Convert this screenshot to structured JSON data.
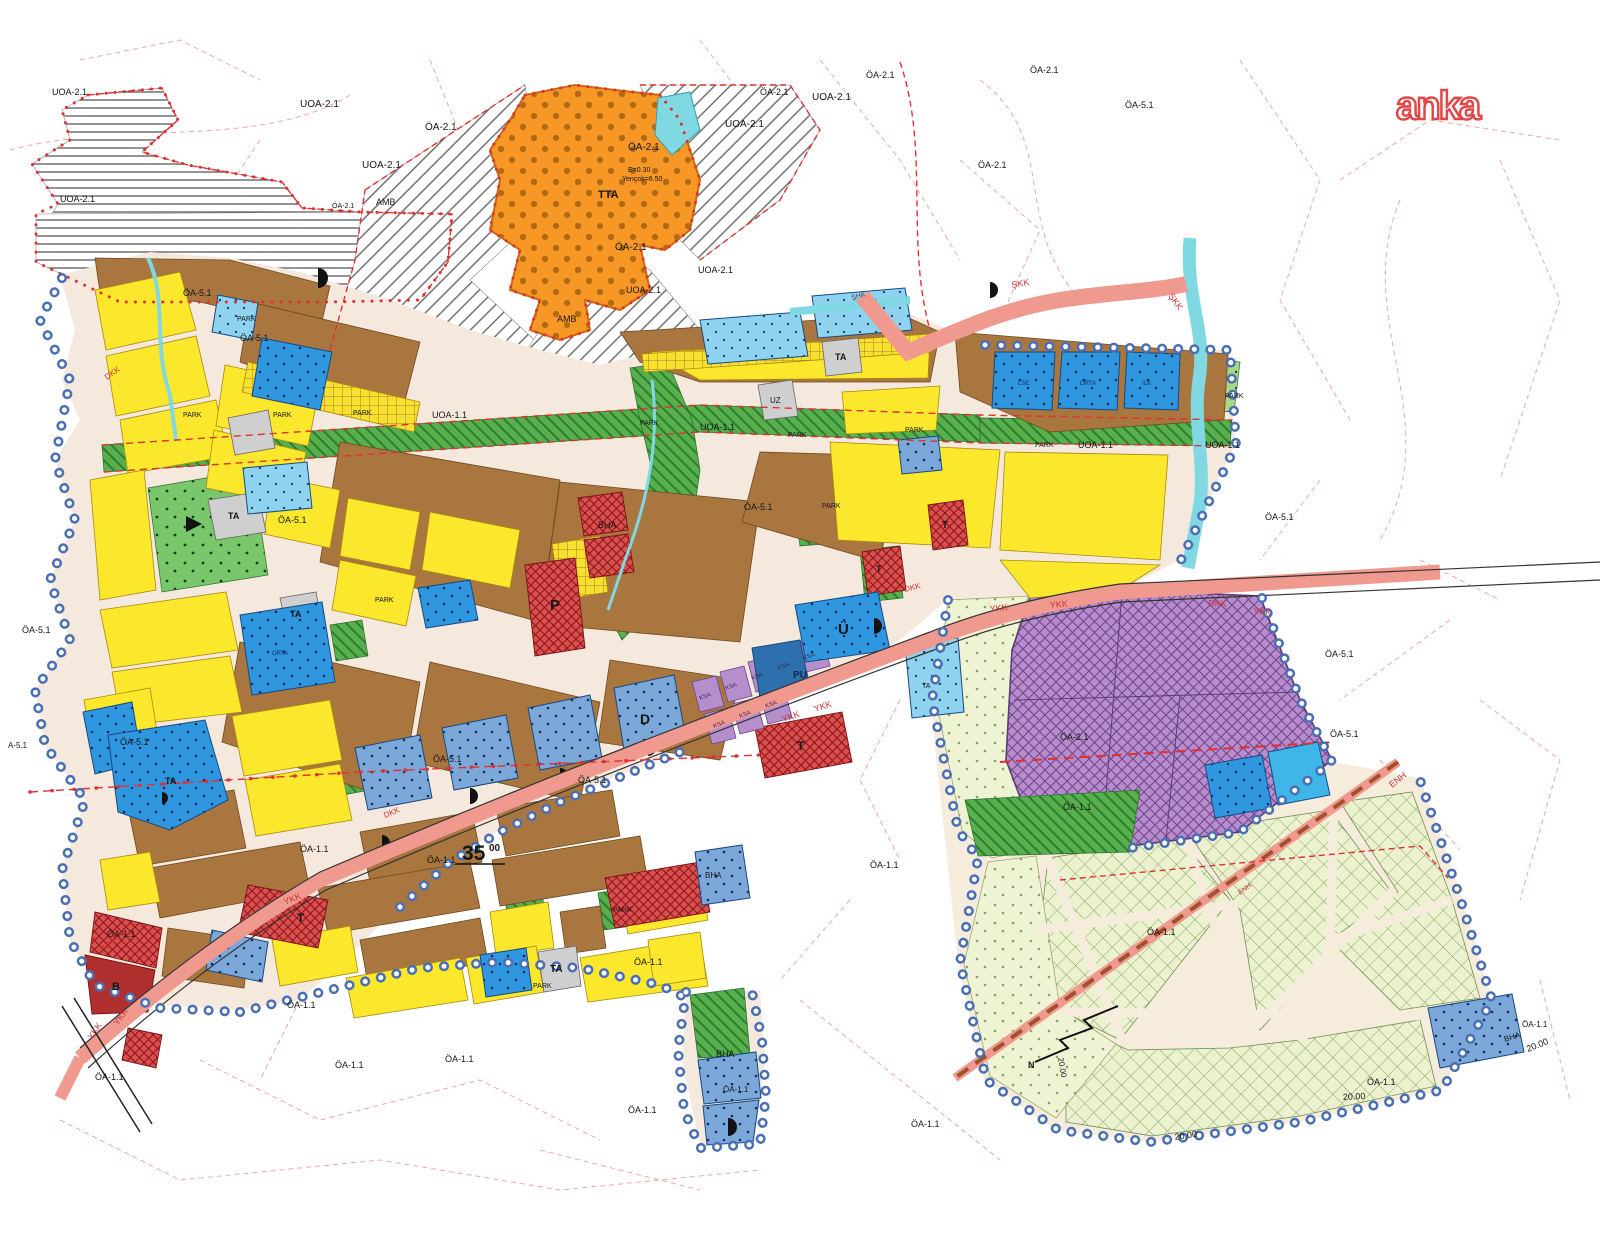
{
  "watermark": {
    "text": "anka"
  },
  "colors": {
    "yellow_residential": "#fbe72b",
    "brown_residential": "#a8763e",
    "green_park": "#57b04b",
    "blue_facility": "#2f96e0",
    "slate_facility": "#7ba7d9",
    "cyan_water": "#7fd8e2",
    "purple_special": "#b68ccb",
    "orange_tta": "#f79726",
    "red_commercial": "#d95050",
    "salmon_road": "#f0998f",
    "pale_green_agri": "#ecf2cf",
    "grey_ta": "#cfcfcf",
    "boundary_blue": "#4a6fb5",
    "boundary_red": "#e03030"
  },
  "map": {
    "labels": [
      {
        "text": "UOA-2.1",
        "x": 52,
        "y": 95,
        "size": 9
      },
      {
        "text": "UOA-2.1",
        "x": 60,
        "y": 202,
        "size": 9
      },
      {
        "text": "UOA-2.1",
        "x": 300,
        "y": 107,
        "size": 10
      },
      {
        "text": "ÖA-2.1",
        "x": 425,
        "y": 130,
        "size": 10
      },
      {
        "text": "UOA-2.1",
        "x": 362,
        "y": 168,
        "size": 10
      },
      {
        "text": "ÖA-2.1",
        "x": 628,
        "y": 150,
        "size": 10
      },
      {
        "text": "E=0.30",
        "x": 628,
        "y": 172,
        "size": 7
      },
      {
        "text": "Yençok=6.50",
        "x": 622,
        "y": 181,
        "size": 7
      },
      {
        "text": "TTA",
        "x": 598,
        "y": 198,
        "size": 11,
        "bold": true
      },
      {
        "text": "ÖA-2.1",
        "x": 615,
        "y": 250,
        "size": 10
      },
      {
        "text": "UOA-2.1",
        "x": 626,
        "y": 293,
        "size": 9
      },
      {
        "text": "UOA-2.1",
        "x": 725,
        "y": 127,
        "size": 10
      },
      {
        "text": "ÖA-2.1",
        "x": 760,
        "y": 95,
        "size": 9
      },
      {
        "text": "UOA-2.1",
        "x": 812,
        "y": 100,
        "size": 10
      },
      {
        "text": "ÖA-2.1",
        "x": 866,
        "y": 78,
        "size": 9
      },
      {
        "text": "ÖA-2.1",
        "x": 1030,
        "y": 73,
        "size": 9
      },
      {
        "text": "ÖA-5.1",
        "x": 1125,
        "y": 108,
        "size": 9
      },
      {
        "text": "ÖA-2.1",
        "x": 978,
        "y": 168,
        "size": 9
      },
      {
        "text": "AMB",
        "x": 376,
        "y": 205,
        "size": 9
      },
      {
        "text": "AMB",
        "x": 557,
        "y": 322,
        "size": 9
      },
      {
        "text": "ÖA-2.1",
        "x": 332,
        "y": 208,
        "size": 7
      },
      {
        "text": "UOA-2.1",
        "x": 698,
        "y": 273,
        "size": 9
      },
      {
        "text": "UOA-1.1",
        "x": 432,
        "y": 418,
        "size": 9
      },
      {
        "text": "UOA-1.1",
        "x": 700,
        "y": 430,
        "size": 9
      },
      {
        "text": "UOA-1.1",
        "x": 1078,
        "y": 448,
        "size": 9
      },
      {
        "text": "UOA-1.1",
        "x": 1205,
        "y": 448,
        "size": 9
      },
      {
        "text": "ŞHK",
        "x": 852,
        "y": 300,
        "size": 7,
        "rot": -15,
        "color": "#444444"
      },
      {
        "text": "ŞKK",
        "x": 1012,
        "y": 288,
        "size": 9,
        "rot": -10,
        "color": "#cc3333"
      },
      {
        "text": "ŞKK",
        "x": 1168,
        "y": 296,
        "size": 9,
        "rot": 55,
        "color": "#cc3333"
      },
      {
        "text": "YKK",
        "x": 990,
        "y": 612,
        "size": 9,
        "rot": -6,
        "color": "#cc3333"
      },
      {
        "text": "YKK",
        "x": 1050,
        "y": 608,
        "size": 9,
        "rot": -4,
        "color": "#cc3333"
      },
      {
        "text": "DKK",
        "x": 1208,
        "y": 606,
        "size": 9,
        "rot": 3,
        "color": "#cc3333"
      },
      {
        "text": "YKK",
        "x": 1253,
        "y": 614,
        "size": 9,
        "rot": 4,
        "color": "#cc3333"
      },
      {
        "text": "YKK",
        "x": 783,
        "y": 722,
        "size": 9,
        "rot": -18,
        "color": "#cc3333"
      },
      {
        "text": "YKK",
        "x": 815,
        "y": 712,
        "size": 9,
        "rot": -18,
        "color": "#cc3333"
      },
      {
        "text": "DKK",
        "x": 905,
        "y": 592,
        "size": 8,
        "rot": -14,
        "color": "#cc3333"
      },
      {
        "text": "YKK",
        "x": 285,
        "y": 905,
        "size": 9,
        "rot": -22,
        "color": "#cc3333"
      },
      {
        "text": "DKK",
        "x": 385,
        "y": 818,
        "size": 8,
        "rot": -22,
        "color": "#cc3333"
      },
      {
        "text": "DKK",
        "x": 107,
        "y": 380,
        "size": 8,
        "rot": -35,
        "color": "#cc3333"
      },
      {
        "text": "YKK",
        "x": 92,
        "y": 1040,
        "size": 9,
        "rot": -55,
        "color": "#cc3333"
      },
      {
        "text": "YKK",
        "x": 118,
        "y": 1026,
        "size": 9,
        "rot": -55,
        "color": "#cc3333"
      },
      {
        "text": "DKK",
        "x": 105,
        "y": 950,
        "size": 8,
        "rot": -40,
        "color": "#cc3333"
      },
      {
        "text": "ENH",
        "x": 1392,
        "y": 788,
        "size": 9,
        "rot": -38,
        "color": "#cc3333"
      },
      {
        "text": "ENH",
        "x": 1240,
        "y": 895,
        "size": 7,
        "rot": -36,
        "color": "#cc3333"
      },
      {
        "text": "35",
        "x": 462,
        "y": 860,
        "size": 21,
        "bold": true
      },
      {
        "text": "00",
        "x": 489,
        "y": 851,
        "size": 10,
        "bold": true
      },
      {
        "text": "20.00",
        "x": 1528,
        "y": 1052,
        "size": 9,
        "rot": -22
      },
      {
        "text": "20.00",
        "x": 1343,
        "y": 1100,
        "size": 9,
        "rot": -3
      },
      {
        "text": "20.00",
        "x": 1175,
        "y": 1140,
        "size": 9,
        "rot": -8
      },
      {
        "text": "20.00",
        "x": 1058,
        "y": 1058,
        "size": 8,
        "rot": 80
      },
      {
        "text": "ÖA-5.1",
        "x": 183,
        "y": 296,
        "size": 9
      },
      {
        "text": "ÖA-5.1",
        "x": 240,
        "y": 341,
        "size": 9
      },
      {
        "text": "ÖA-5.1",
        "x": 278,
        "y": 523,
        "size": 9
      },
      {
        "text": "ÖA-5.1",
        "x": 744,
        "y": 510,
        "size": 9
      },
      {
        "text": "ÖA-5.1",
        "x": 22,
        "y": 633,
        "size": 9
      },
      {
        "text": "ÖA-5.1",
        "x": 120,
        "y": 745,
        "size": 9
      },
      {
        "text": "ÖA-5.1",
        "x": 433,
        "y": 762,
        "size": 9
      },
      {
        "text": "ÖA-5.1",
        "x": 578,
        "y": 783,
        "size": 9
      },
      {
        "text": "A-5.1",
        "x": 8,
        "y": 748,
        "size": 8
      },
      {
        "text": "ÖA-1.1",
        "x": 300,
        "y": 852,
        "size": 9
      },
      {
        "text": "ÖA-1.1",
        "x": 427,
        "y": 863,
        "size": 9
      },
      {
        "text": "ÖA-1.1",
        "x": 107,
        "y": 937,
        "size": 9
      },
      {
        "text": "ÖA-1.1",
        "x": 287,
        "y": 1008,
        "size": 9
      },
      {
        "text": "ÖA-1.1",
        "x": 95,
        "y": 1080,
        "size": 9
      },
      {
        "text": "ÖA-1.1",
        "x": 335,
        "y": 1068,
        "size": 9
      },
      {
        "text": "ÖA-1.1",
        "x": 445,
        "y": 1062,
        "size": 9
      },
      {
        "text": "ÖA-1.1",
        "x": 628,
        "y": 1113,
        "size": 9
      },
      {
        "text": "ÖA-1.1",
        "x": 911,
        "y": 1127,
        "size": 9
      },
      {
        "text": "ÖA-1.1",
        "x": 634,
        "y": 965,
        "size": 9
      },
      {
        "text": "ÖA-1.1",
        "x": 723,
        "y": 1092,
        "size": 8
      },
      {
        "text": "ÖA-1.1",
        "x": 1063,
        "y": 810,
        "size": 9
      },
      {
        "text": "ÖA-1.1",
        "x": 1147,
        "y": 935,
        "size": 9
      },
      {
        "text": "ÖA-1.1",
        "x": 1367,
        "y": 1085,
        "size": 9
      },
      {
        "text": "ÖA-1.1",
        "x": 1522,
        "y": 1027,
        "size": 8
      },
      {
        "text": "ÖA-1.1",
        "x": 870,
        "y": 868,
        "size": 9
      },
      {
        "text": "ÖA-5.1",
        "x": 1265,
        "y": 520,
        "size": 9
      },
      {
        "text": "ÖA-5.1",
        "x": 1325,
        "y": 657,
        "size": 9
      },
      {
        "text": "ÖA-5.1",
        "x": 1330,
        "y": 737,
        "size": 9
      },
      {
        "text": "ÖA-2.1",
        "x": 1060,
        "y": 740,
        "size": 9
      },
      {
        "text": "PARK",
        "x": 237,
        "y": 321,
        "size": 7
      },
      {
        "text": "PARK",
        "x": 183,
        "y": 417,
        "size": 7
      },
      {
        "text": "PARK",
        "x": 273,
        "y": 417,
        "size": 7
      },
      {
        "text": "PARK",
        "x": 353,
        "y": 415,
        "size": 7
      },
      {
        "text": "PARK",
        "x": 640,
        "y": 425,
        "size": 7
      },
      {
        "text": "PARK",
        "x": 788,
        "y": 437,
        "size": 7
      },
      {
        "text": "PARK",
        "x": 905,
        "y": 432,
        "size": 7
      },
      {
        "text": "PARK",
        "x": 1035,
        "y": 447,
        "size": 7
      },
      {
        "text": "PARK",
        "x": 1225,
        "y": 398,
        "size": 7
      },
      {
        "text": "PARK",
        "x": 375,
        "y": 602,
        "size": 7
      },
      {
        "text": "PARK",
        "x": 822,
        "y": 508,
        "size": 7
      },
      {
        "text": "PARK",
        "x": 533,
        "y": 988,
        "size": 7
      },
      {
        "text": "PARK",
        "x": 613,
        "y": 912,
        "size": 7
      },
      {
        "text": "P",
        "x": 550,
        "y": 610,
        "size": 15,
        "bold": true
      },
      {
        "text": "BHA",
        "x": 598,
        "y": 528,
        "size": 9
      },
      {
        "text": "BHA",
        "x": 705,
        "y": 878,
        "size": 8
      },
      {
        "text": "BHA",
        "x": 716,
        "y": 1057,
        "size": 9
      },
      {
        "text": "BHA",
        "x": 1505,
        "y": 1042,
        "size": 8,
        "rot": -18
      },
      {
        "text": "TA",
        "x": 228,
        "y": 519,
        "size": 9,
        "bold": true
      },
      {
        "text": "TA",
        "x": 290,
        "y": 617,
        "size": 9,
        "bold": true
      },
      {
        "text": "TA",
        "x": 165,
        "y": 784,
        "size": 9,
        "bold": true
      },
      {
        "text": "TA",
        "x": 550,
        "y": 972,
        "size": 10,
        "bold": true
      },
      {
        "text": "TA",
        "x": 835,
        "y": 360,
        "size": 9,
        "bold": true
      },
      {
        "text": "TA",
        "x": 922,
        "y": 688,
        "size": 7
      },
      {
        "text": "UZ",
        "x": 770,
        "y": 403,
        "size": 8
      },
      {
        "text": "Ü",
        "x": 838,
        "y": 634,
        "size": 15,
        "bold": true
      },
      {
        "text": "PU",
        "x": 793,
        "y": 678,
        "size": 10,
        "bold": true,
        "color": "#102a4a"
      },
      {
        "text": "D",
        "x": 640,
        "y": 724,
        "size": 14,
        "bold": true
      },
      {
        "text": "KSA",
        "x": 700,
        "y": 700,
        "size": 6,
        "rot": -20,
        "color": "#3a2950"
      },
      {
        "text": "KSA",
        "x": 726,
        "y": 690,
        "size": 6,
        "rot": -20,
        "color": "#3a2950"
      },
      {
        "text": "KSA",
        "x": 752,
        "y": 680,
        "size": 6,
        "rot": -20,
        "color": "#3a2950"
      },
      {
        "text": "KSA",
        "x": 778,
        "y": 670,
        "size": 6,
        "rot": -20,
        "color": "#3a2950"
      },
      {
        "text": "KSA",
        "x": 714,
        "y": 728,
        "size": 6,
        "rot": -20,
        "color": "#3a2950"
      },
      {
        "text": "KSA",
        "x": 740,
        "y": 718,
        "size": 6,
        "rot": -20,
        "color": "#3a2950"
      },
      {
        "text": "KSA",
        "x": 766,
        "y": 708,
        "size": 6,
        "rot": -20,
        "color": "#3a2950"
      },
      {
        "text": "KSA",
        "x": 804,
        "y": 660,
        "size": 6,
        "rot": -20,
        "color": "#3a2950"
      },
      {
        "text": "T",
        "x": 797,
        "y": 750,
        "size": 12,
        "bold": true
      },
      {
        "text": "T",
        "x": 297,
        "y": 922,
        "size": 12,
        "bold": true
      },
      {
        "text": "T",
        "x": 942,
        "y": 528,
        "size": 10,
        "bold": true
      },
      {
        "text": "T",
        "x": 876,
        "y": 572,
        "size": 9,
        "bold": true
      },
      {
        "text": "B",
        "x": 112,
        "y": 990,
        "size": 11,
        "bold": true
      },
      {
        "text": "ORTA",
        "x": 272,
        "y": 655,
        "size": 6,
        "color": "#0b2e5b"
      },
      {
        "text": "LSE",
        "x": 1018,
        "y": 385,
        "size": 6,
        "color": "#0b2e5b"
      },
      {
        "text": "ORTA",
        "x": 1080,
        "y": 385,
        "size": 6,
        "color": "#0b2e5b"
      },
      {
        "text": "İLK",
        "x": 1142,
        "y": 385,
        "size": 6,
        "color": "#0b2e5b"
      },
      {
        "text": "N",
        "x": 1028,
        "y": 1068,
        "size": 9,
        "bold": true
      }
    ]
  }
}
